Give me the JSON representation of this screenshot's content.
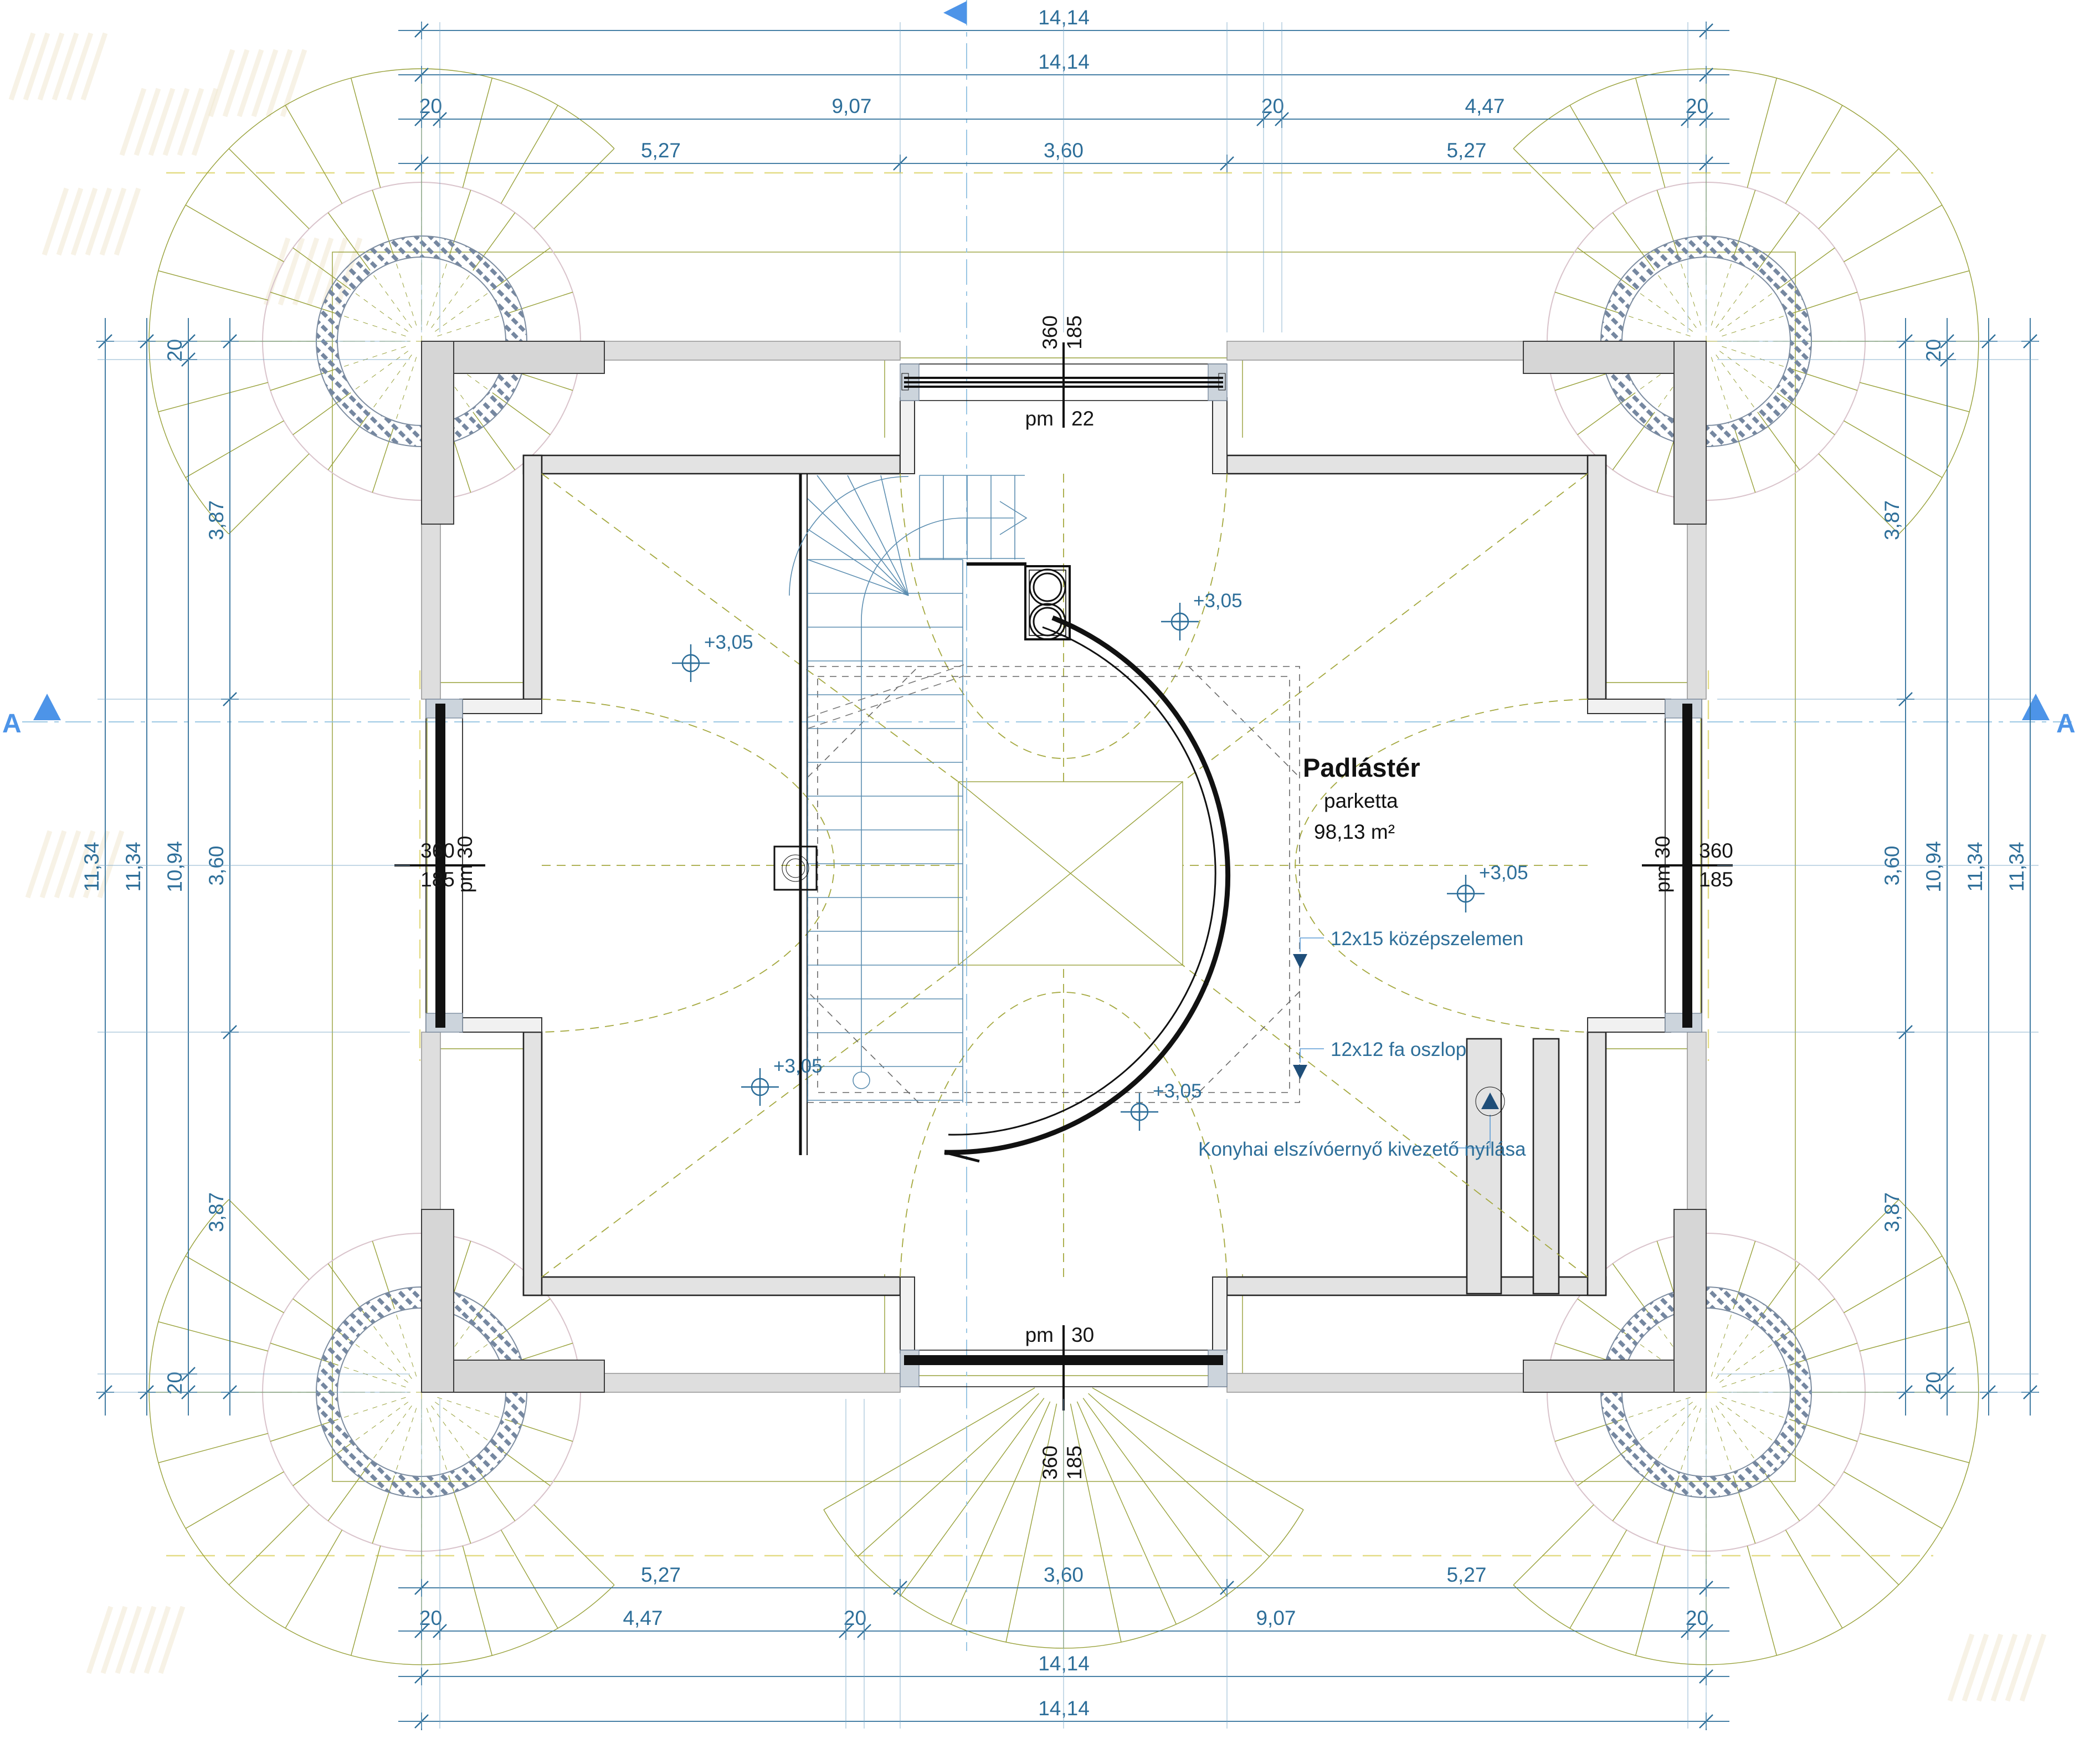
{
  "room": {
    "name": "Padlástér",
    "finish": "parketta",
    "area": "98,13 m²"
  },
  "labels": {
    "purlin": "12x15 középszelemen",
    "post": "12x12 fa oszlop",
    "kitchen_vent": "Konyhai elszívóernyő kivezető nyílása",
    "level": "+3,05",
    "section": "A"
  },
  "windows": {
    "top": {
      "width": "360",
      "height": "185",
      "parapet": "pm 22"
    },
    "bottom": {
      "width": "360",
      "height": "185",
      "parapet": "pm 30"
    },
    "left": {
      "width": "360",
      "height": "185",
      "parapet": "pm 30"
    },
    "right": {
      "width": "360",
      "height": "185",
      "parapet": "pm 30"
    }
  },
  "dimensions": {
    "top": [
      [
        "14,14"
      ],
      [
        "14,14"
      ],
      [
        "20",
        "9,07",
        "20",
        "4,47",
        "20"
      ],
      [
        "5,27",
        "3,60",
        "5,27"
      ]
    ],
    "bottom": [
      [
        "5,27",
        "3,60",
        "5,27"
      ],
      [
        "20",
        "4,47",
        "20",
        "9,07",
        "20"
      ],
      [
        "14,14"
      ],
      [
        "14,14"
      ]
    ],
    "left": [
      [
        "11,34"
      ],
      [
        "11,34"
      ],
      [
        "20",
        "10,94",
        "20"
      ],
      [
        "3,87",
        "3,60",
        "3,87"
      ]
    ],
    "right": [
      [
        "3,87",
        "3,60",
        "3,87"
      ],
      [
        "20",
        "10,94",
        "20"
      ],
      [
        "11,34"
      ],
      [
        "11,34"
      ]
    ]
  },
  "colors": {
    "dimension_blue": "#2d6e99",
    "marker_blue": "#4d94e8",
    "roof_olive": "#97a038",
    "pale_yellow": "#e3dc84",
    "wall_gray": "#dedede",
    "hatch_gray": "#7587a0",
    "line_black": "#111111"
  }
}
